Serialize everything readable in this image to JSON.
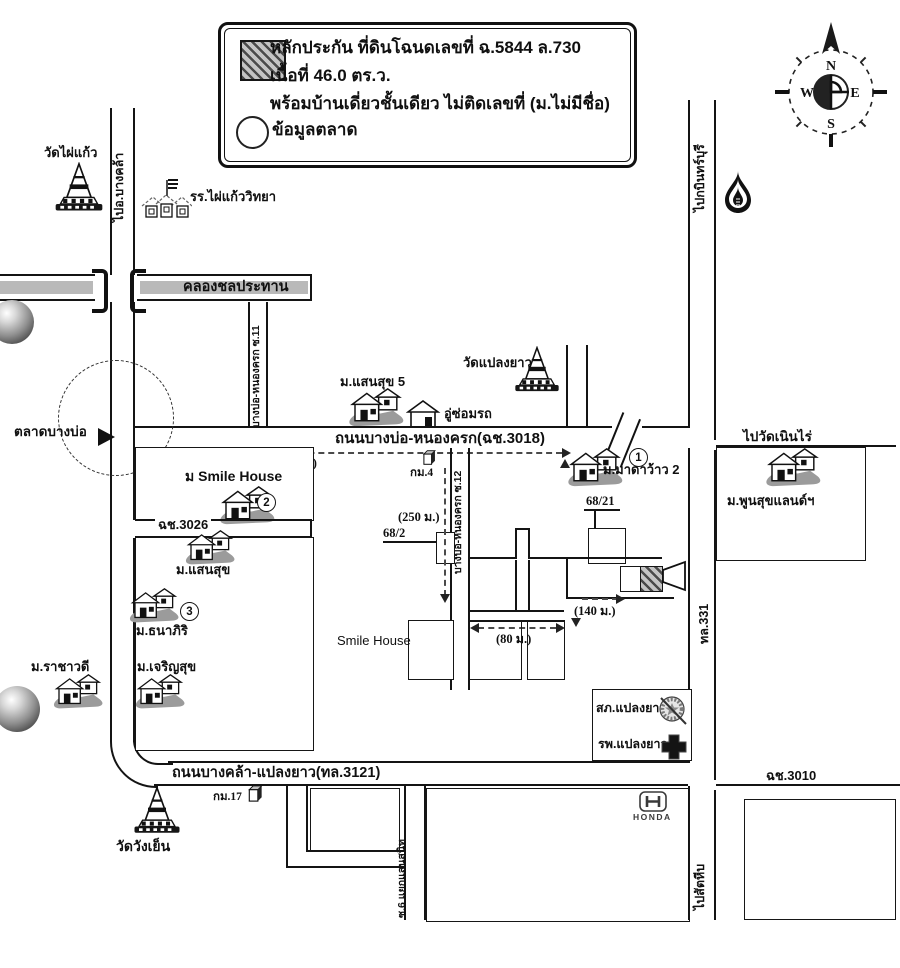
{
  "legend": {
    "line1": "หลักประกัน ที่ดินโฉนดเลขที่ ฉ.5844 ล.730",
    "line2": "เนื้อที่ 46.0 ตร.ว.",
    "line3": "พร้อมบ้านเดี่ยวชั้นเดียว ไม่ติดเลขที่ (ม.ไม่มีชื่อ)",
    "line4": "ข้อมูลตลาด"
  },
  "compass": {
    "n": "N",
    "e": "E",
    "s": "S",
    "w": "W"
  },
  "markers": {
    "no1": "1",
    "no2": "2",
    "no3": "3"
  },
  "colors": {
    "ink": "#141414",
    "canal_gray": "#b9b9b9",
    "shadow_gray": "#9b9b9b"
  },
  "labels": {
    "wat_phai_kaeo": "วัดไผ่แก้ว",
    "to_bang_khla": "ไปอ.บางคล้า",
    "school_phai_kaeo": "รร.ไผ่แก้ววิทยา",
    "canal": "คลองชลประทาน",
    "to_kabin_buri": "ไปกบินทร์บุรี",
    "soi11": "บางบ่อ-หนองครก ซ.11",
    "msansuk5": "ม.แสนสุข 5",
    "garage": "อู่ซ่อมรถ",
    "wat_plaeng_yao": "วัดแปลงยาว",
    "main_road": "ถนนบางบ่อ-หนองครก(ฉช.3018)",
    "to_wat_noen_rai": "ไปวัดเนินไร่",
    "talat_bang_bo": "ตลาดบางบ่อ",
    "dist_2100": "(2,100 ม.)",
    "km4": "กม.4",
    "smile_house_th": "ม Smile House",
    "madawow2": "ม.มาดาว้าว 2",
    "no68_21": "68/21",
    "no68_2": "68/2",
    "dist_250": "(250 ม.)",
    "soi12": "บางบ่อ-หนองครก ซ.12",
    "phunsuk_land": "ม.พูนสุขแลนด์ฯ",
    "cch3026": "ฉช.3026",
    "msansuk": "ม.แสนสุข",
    "thanaphiri": "ม.ธนาภิริ",
    "rachawadee": "ม.ราชาวดี",
    "charoensuk": "ม.เจริญสุข",
    "smile_house_en": "Smile House",
    "dist_140": "(140 ม.)",
    "dist_80": "(80 ม.)",
    "tl331": "ทล.331",
    "police": "สภ.แปลงยาว",
    "hospital": "รพ.แปลงยาว",
    "bottom_road": "ถนนบางคล้า-แปลงยาว(ทล.3121)",
    "km17": "กม.17",
    "wat_wang_yen": "วัดวังเย็น",
    "soi6": "ซ.6 แยกแสนสนิท",
    "honda": "HONDA",
    "cch3010": "ฉช.3010",
    "to_sattahip": "ไปสัตหีบ"
  }
}
